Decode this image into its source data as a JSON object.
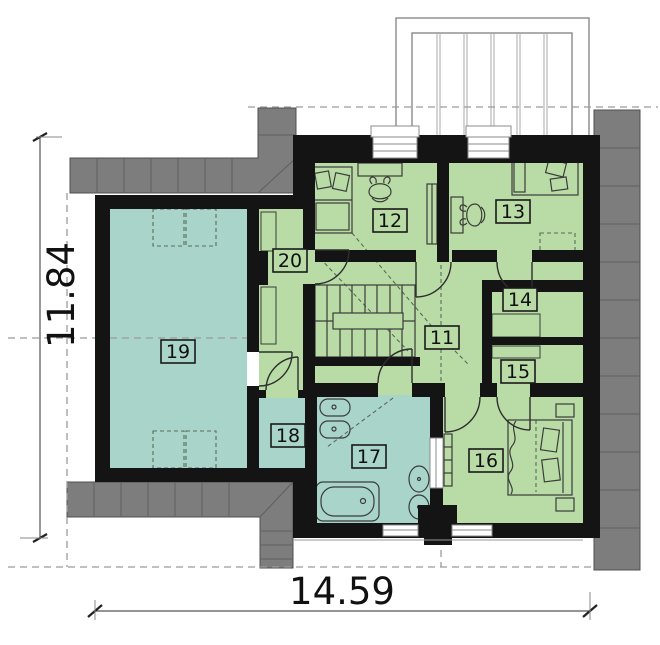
{
  "dimensions": {
    "height_label": "11.84",
    "width_label": "14.59"
  },
  "rooms": {
    "r11": "11",
    "r12": "12",
    "r13": "13",
    "r14": "14",
    "r15": "15",
    "r16": "16",
    "r17": "17",
    "r18": "18",
    "r19": "19",
    "r20": "20"
  },
  "colors": {
    "green": "#b9dca6",
    "teal": "#a9d4c9",
    "roof": "#7d7d7d",
    "wall": "#141414"
  }
}
